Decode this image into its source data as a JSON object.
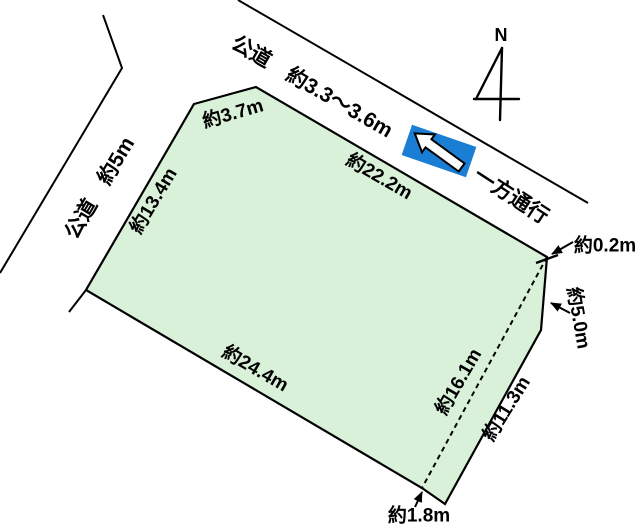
{
  "roads": {
    "top_label": "公道　約3.3～3.6m",
    "left_label": "公道　約5m"
  },
  "north_label": "N",
  "one_way_label": "一方通行",
  "dims": {
    "edge_top_short": "約3.7m",
    "edge_top_long": "約22.2m",
    "edge_left": "約13.4m",
    "edge_bottom": "約24.4m",
    "diagonal": "約16.1m",
    "edge_right_lower": "約11.3m",
    "edge_right_upper": "約5.0m",
    "corner_northeast": "約0.2m",
    "corner_south": "約1.8m"
  },
  "colors": {
    "plot_fill": "#d9f0d9",
    "line": "#000000",
    "one_way_blue": "#1a7fd4",
    "background": "#ffffff"
  }
}
